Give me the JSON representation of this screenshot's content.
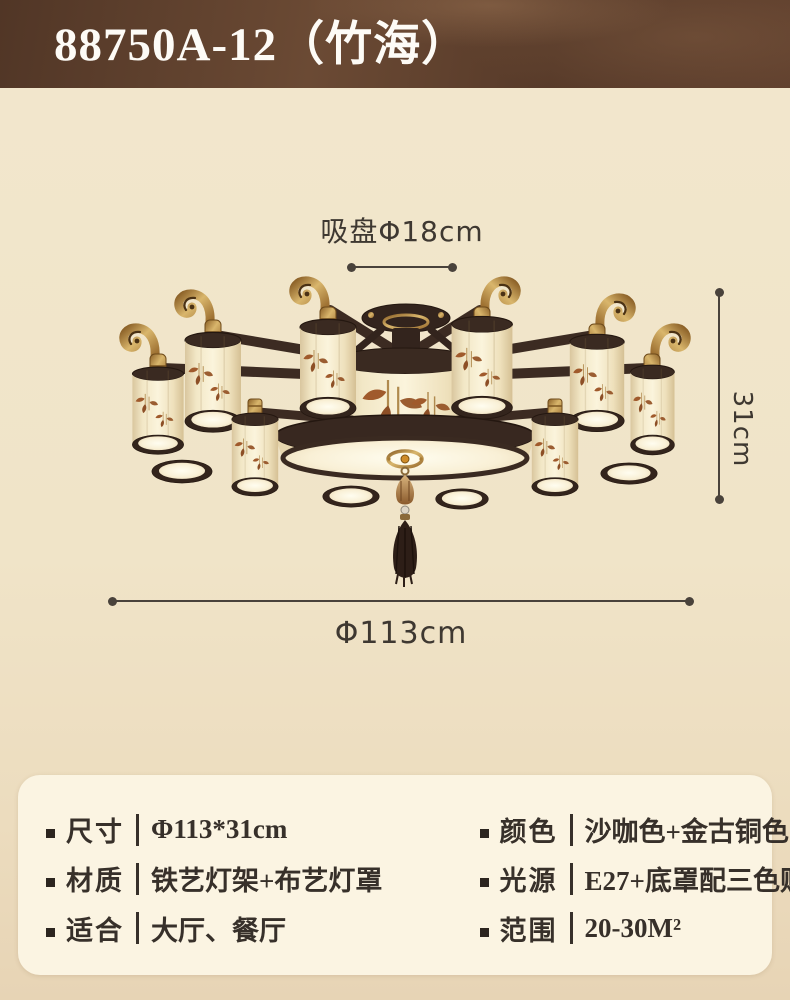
{
  "header": {
    "title": "88750A-12（竹海）"
  },
  "dimensions": {
    "suction_plate": "吸盘Φ18cm",
    "height": "31cm",
    "diameter": "Φ113cm"
  },
  "specs": {
    "left": [
      {
        "label": "尺寸",
        "value": "Φ113*31cm"
      },
      {
        "label": "材质",
        "value": "铁艺灯架+布艺灯罩"
      },
      {
        "label": "适合",
        "value": "大厅、餐厅"
      }
    ],
    "right": [
      {
        "label": "颜色",
        "value": "沙咖色+金古铜色"
      },
      {
        "label": "光源",
        "value": "E27+底罩配三色贴片"
      },
      {
        "label": "范围",
        "value": "20-30M²"
      }
    ]
  },
  "colors": {
    "banner_background": "#5d3e2b",
    "banner_text": "#fdfbf6",
    "page_background": "#f0e4c8",
    "card_background": "#fbf4e2",
    "spec_text": "#37302a",
    "dimension_line": "#49423b",
    "lamp_frame_brown": "#33241c",
    "lamp_shade_cream": "#f7eed4",
    "lamp_brass_gold": "#c9a257",
    "bamboo_motif": "#9b5d31"
  }
}
